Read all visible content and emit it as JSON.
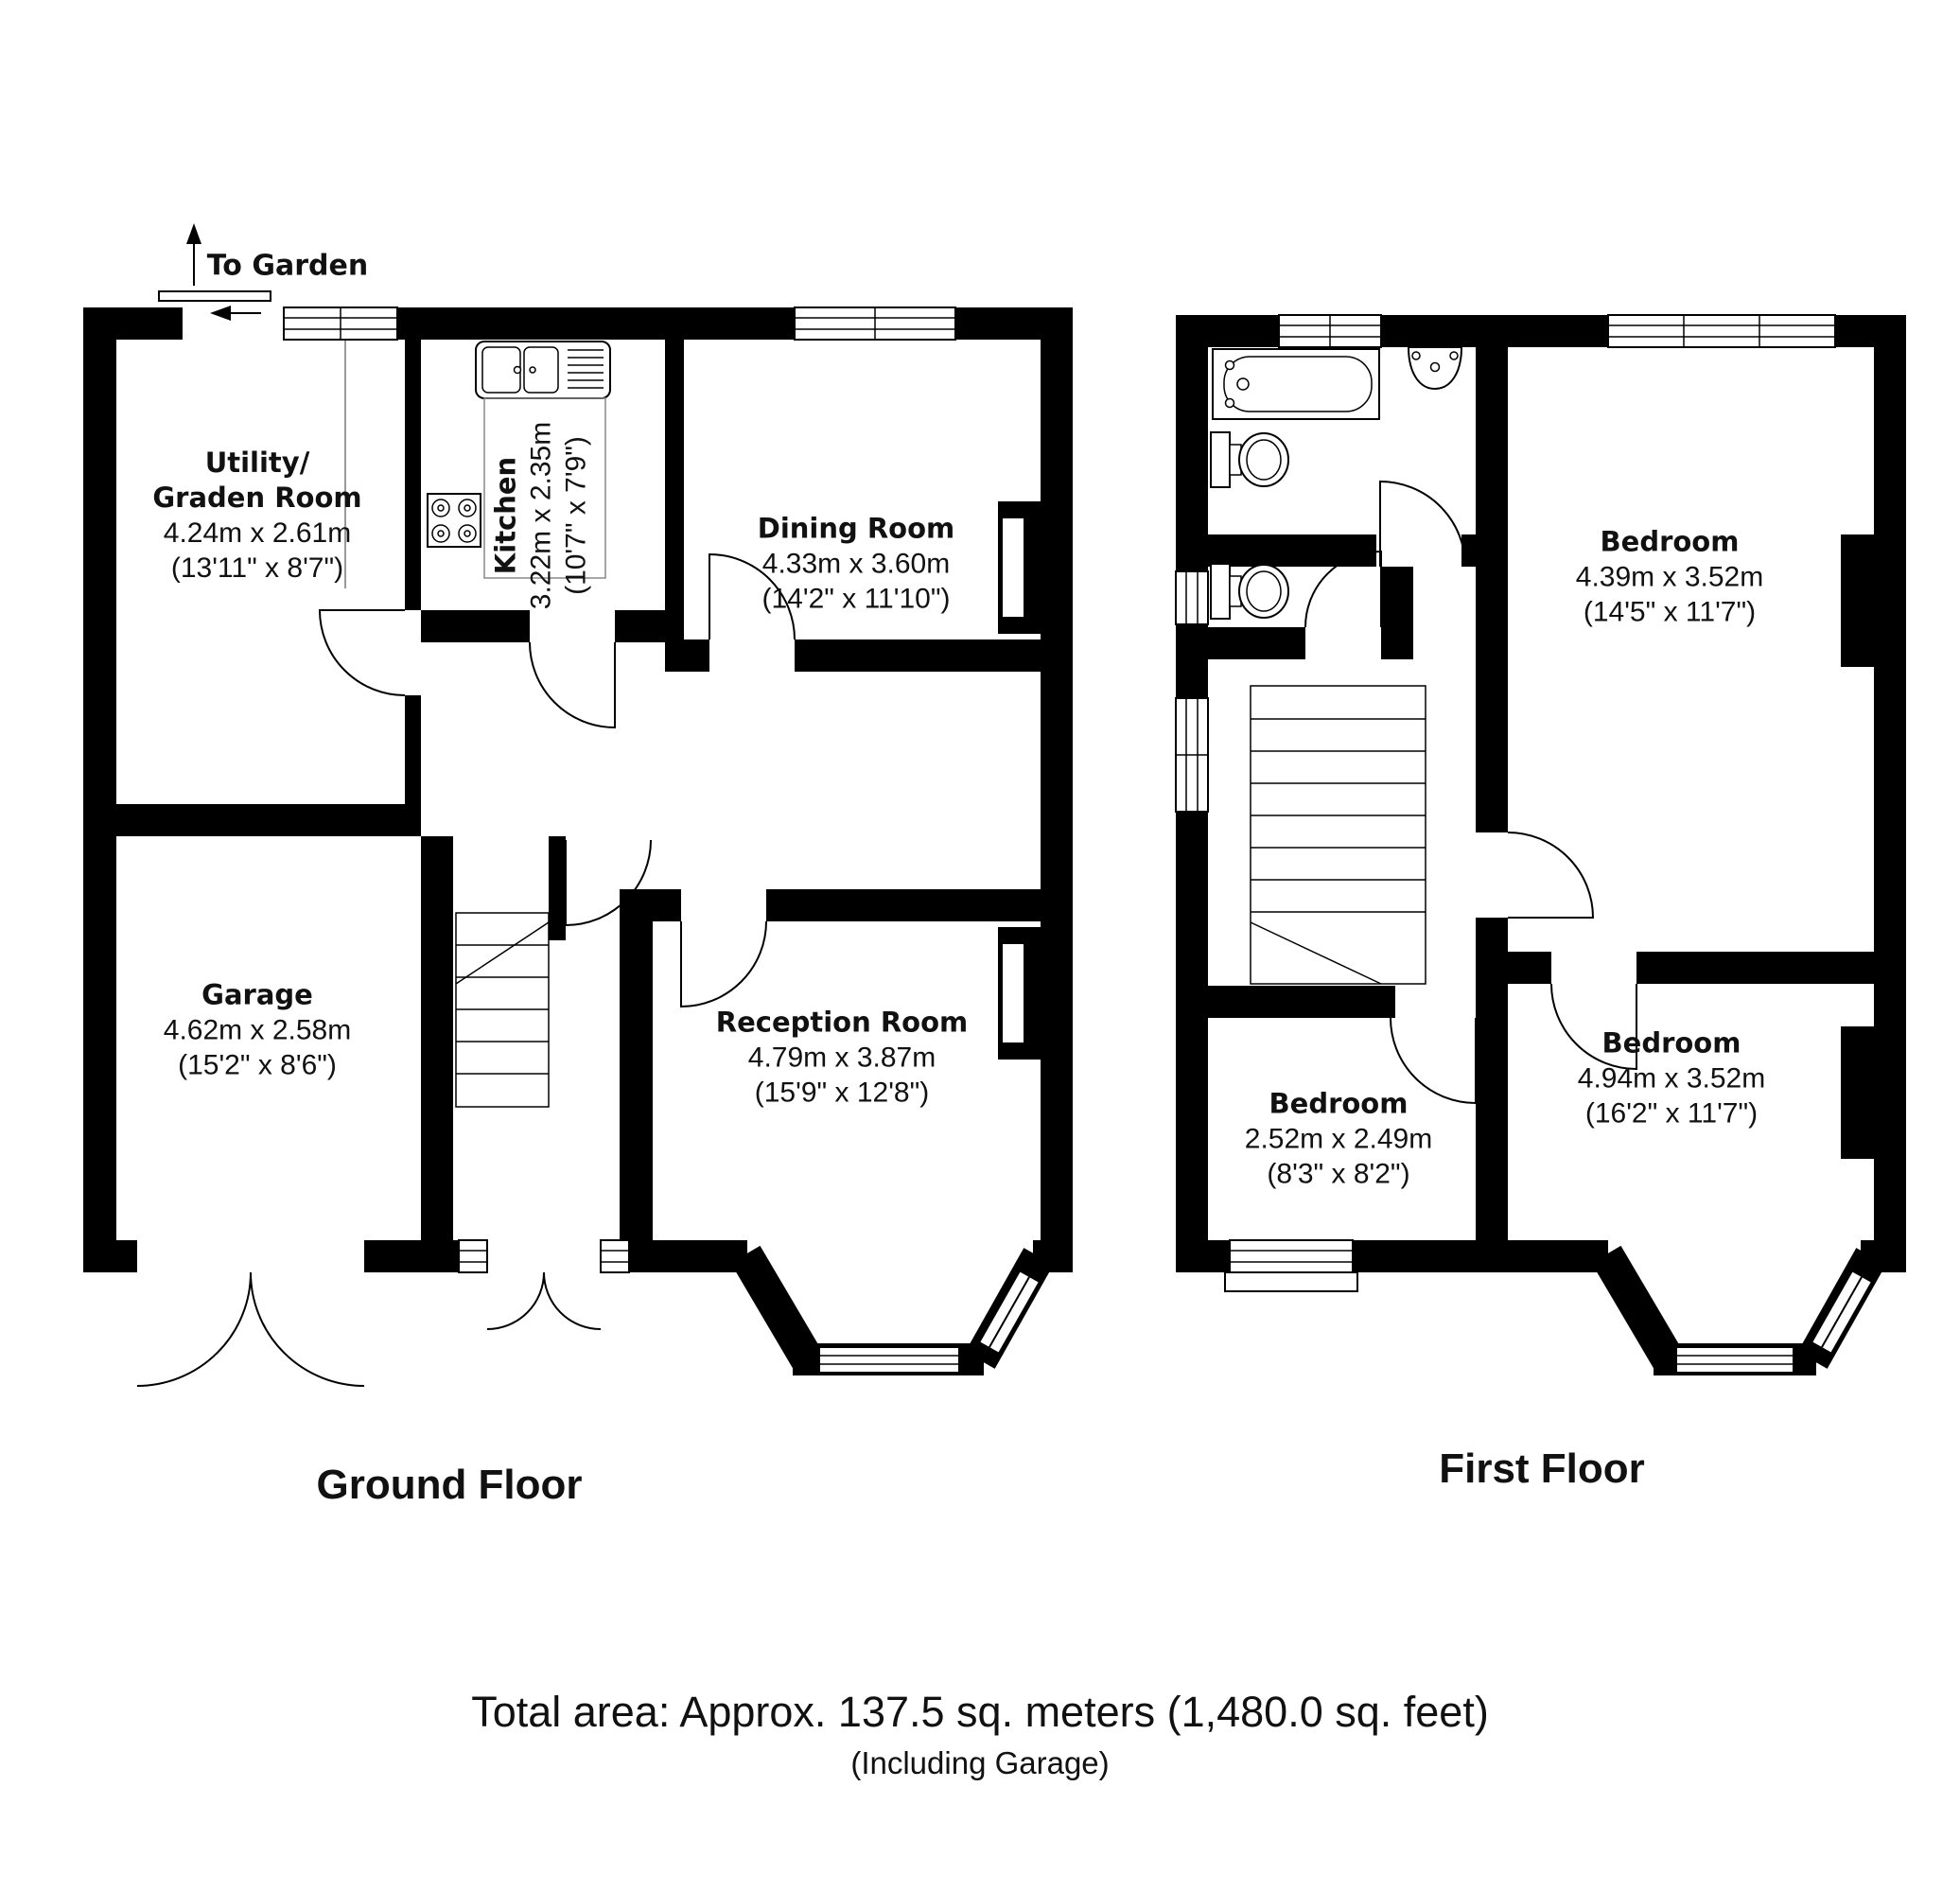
{
  "ground_floor": {
    "title": "Ground Floor",
    "garden_label": "To Garden",
    "rooms": {
      "utility": {
        "name_line1": "Utility/",
        "name_line2": "Graden Room",
        "dims_m": "4.24m x 2.61m",
        "dims_ft": "(13'11\" x 8'7\")"
      },
      "kitchen": {
        "name": "Kitchen",
        "dims_m": "3.22m x 2.35m",
        "dims_ft": "(10'7\" x 7'9\")"
      },
      "dining_room": {
        "name": "Dining Room",
        "dims_m": "4.33m x 3.60m",
        "dims_ft": "(14'2\" x 11'10\")"
      },
      "garage": {
        "name": "Garage",
        "dims_m": "4.62m x 2.58m",
        "dims_ft": "(15'2\" x 8'6\")"
      },
      "reception_room": {
        "name": "Reception Room",
        "dims_m": "4.79m x 3.87m",
        "dims_ft": "(15'9\" x 12'8\")"
      }
    }
  },
  "first_floor": {
    "title": "First Floor",
    "rooms": {
      "bedroom_rear": {
        "name": "Bedroom",
        "dims_m": "4.39m x 3.52m",
        "dims_ft": "(14'5\" x 11'7\")"
      },
      "bedroom_front": {
        "name": "Bedroom",
        "dims_m": "4.94m x 3.52m",
        "dims_ft": "(16'2\" x 11'7\")"
      },
      "bedroom_small": {
        "name": "Bedroom",
        "dims_m": "2.52m x 2.49m",
        "dims_ft": "(8'3\" x 8'2\")"
      }
    }
  },
  "footer": {
    "total_area": "Total area: Approx. 137.5 sq. meters (1,480.0 sq. feet)",
    "note": "(Including Garage)"
  },
  "icons": {
    "bath": "bath-tub-icon",
    "basin": "wash-basin-icon",
    "toilet": "toilet-icon",
    "sink": "kitchen-sink-icon",
    "hob": "cooker-hob-icon",
    "stairs": "staircase-icon",
    "garden_arrow": "arrow-icon"
  },
  "colors": {
    "wall": "#000000",
    "background": "#ffffff",
    "line": "#000000"
  }
}
